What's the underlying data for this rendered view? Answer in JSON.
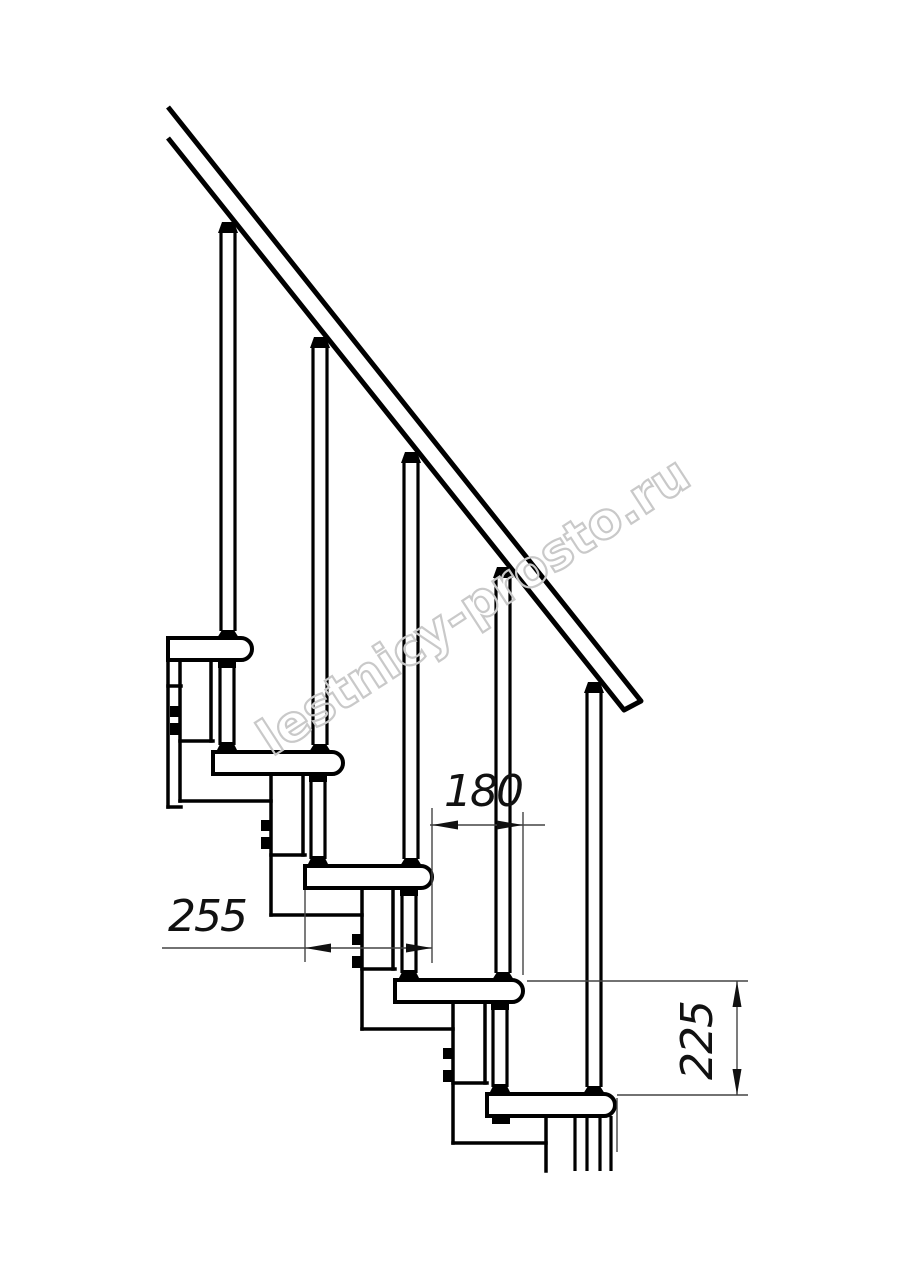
{
  "page": {
    "background": "#ffffff",
    "width": 914,
    "height": 1280
  },
  "drawing": {
    "description": "Side elevation technical drawing of a modular staircase: diagonal handrail, five treads with rounded noses, balusters, inter-tread support rods and central stringer modules with bolt lugs",
    "line_color": "#000000",
    "dimension_line_color": "#444444",
    "text_color": "#111111"
  },
  "dimensions": {
    "d180": {
      "label": "180"
    },
    "d255": {
      "label": "255"
    },
    "d225": {
      "label": "225"
    }
  },
  "watermark": {
    "text": "lestnicy-prosto.ru",
    "color": "#c9c9c9"
  }
}
